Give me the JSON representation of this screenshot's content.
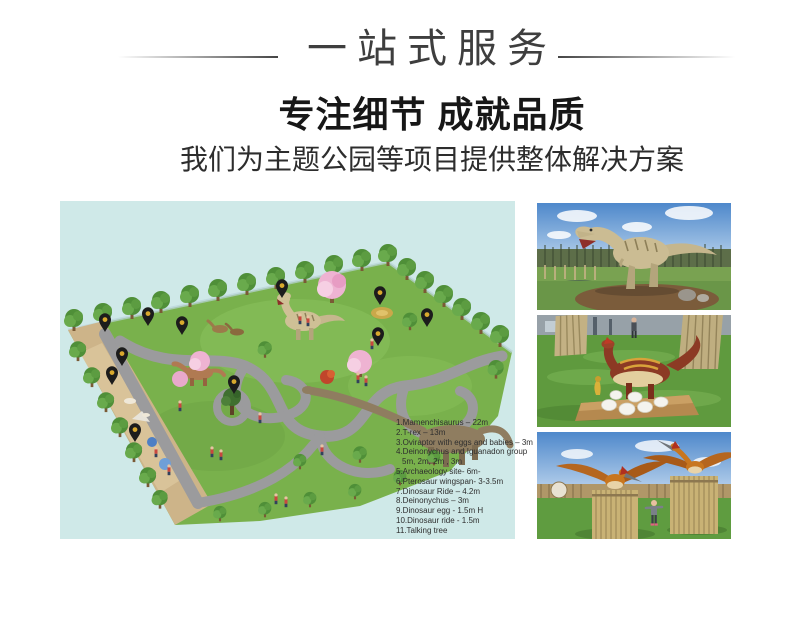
{
  "header": {
    "banner_title": "一站式服务",
    "heading": "专注细节 成就品质",
    "subheading": "我们为主题公园等项目提供整体解决方案"
  },
  "park_plan": {
    "panel_bg": "#cfe9e8",
    "legend": [
      "1.Mamenchisaurus – 22m",
      "2.T-rex – 13m",
      "3.Oviraptor with eggs and babies – 3m",
      "4.Deinonychus and Iguanadon group",
      "5m, 2m, 2m , 3m",
      "5.Archaeology site- 6m-",
      "6.Pterosaur  wingspan- 3-3.5m",
      "7.Dinosaur Ride – 4.2m",
      "8.Deinonychus – 3m",
      "9.Dinosaur egg - 1.5m H",
      "10.Dinosaur ride -  1.5m",
      "11.Talking tree"
    ],
    "pin_count": 11
  },
  "photos": [
    {
      "name": "trex-display-photo"
    },
    {
      "name": "oviraptor-eggs-photo"
    },
    {
      "name": "pterosaur-posts-photo"
    }
  ],
  "colors": {
    "panel_cyan": "#cfe9e8",
    "pin_black": "#1c1c1c",
    "pin_dot_yellow": "#d9a92d",
    "lawn_green": "#79b14c",
    "path_gray": "#9b9b9d",
    "sand_tan": "#cdb489"
  }
}
